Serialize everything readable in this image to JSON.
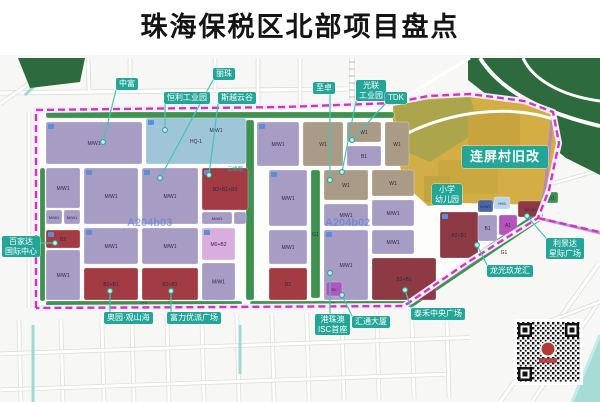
{
  "title": "珠海保税区北部项目盘点",
  "map": {
    "colors": {
      "purple": "#a79cc4",
      "lightblue": "#9fc6d8",
      "red": "#a23b42",
      "maroon": "#8e3a44",
      "tan": "#a99b85",
      "pink": "#d9aede",
      "magenta": "#b455bd",
      "steel": "#4a66aa",
      "pale": "#b9d6e8",
      "green": "#3f9150",
      "darkgreen": "#2d6b3f",
      "yellow": "#d2ae45",
      "olive": "#a8a44c",
      "boundary": "#cf35c4",
      "pointer": "#45c4b8",
      "water": "#a7dbd6",
      "areacode": "#5a7fd0",
      "chip": "#23a598"
    },
    "area_codes": [
      {
        "text": "A204b03",
        "x": 127,
        "y": 226
      },
      {
        "text": "A204b02",
        "x": 325,
        "y": 226
      }
    ],
    "road_labels": [
      {
        "text": "云峰路",
        "x": 235,
        "y": 171
      }
    ],
    "chips": [
      {
        "id": "zhongfu",
        "lines": [
          "中富"
        ],
        "x": 116,
        "y": 78,
        "dot": [
          103,
          142
        ]
      },
      {
        "id": "lizhu",
        "lines": [
          "丽珠"
        ],
        "x": 213,
        "y": 68,
        "dot": [
          160,
          178
        ]
      },
      {
        "id": "hengli",
        "lines": [
          "恒利工业园"
        ],
        "x": 164,
        "y": 92,
        "dot": [
          165,
          130
        ]
      },
      {
        "id": "siyue",
        "lines": [
          "斯越云谷"
        ],
        "x": 218,
        "y": 92,
        "dot": [
          209,
          175
        ]
      },
      {
        "id": "zhizhuo",
        "lines": [
          "至卓"
        ],
        "x": 313,
        "y": 82,
        "dot": [
          330,
          180
        ]
      },
      {
        "id": "guanglian",
        "lines": [
          "光联",
          "工业园"
        ],
        "x": 356,
        "y": 80,
        "dot": [
          342,
          172
        ]
      },
      {
        "id": "tdk",
        "lines": [
          "TDK"
        ],
        "x": 385,
        "y": 92,
        "dot": [
          352,
          140
        ]
      },
      {
        "id": "lianping",
        "lines": [
          "连屏村旧改"
        ],
        "x": 462,
        "y": 146,
        "big": true
      },
      {
        "id": "school",
        "lines": [
          "小学",
          "幼儿园"
        ],
        "x": 432,
        "y": 184
      },
      {
        "id": "baijiada",
        "lines": [
          "百家达",
          "国际中心"
        ],
        "x": 2,
        "y": 236,
        "dot": [
          55,
          243
        ]
      },
      {
        "id": "lijingda",
        "lines": [
          "利景达",
          "星际广场"
        ],
        "x": 546,
        "y": 238,
        "dot": [
          527,
          216
        ]
      },
      {
        "id": "longguang",
        "lines": [
          "龙光玖龙汇"
        ],
        "x": 487,
        "y": 265,
        "dot": [
          477,
          245
        ]
      },
      {
        "id": "taihe",
        "lines": [
          "泰禾中央广场"
        ],
        "x": 411,
        "y": 308,
        "dot": [
          405,
          290
        ]
      },
      {
        "id": "huitong",
        "lines": [
          "汇通大厦"
        ],
        "x": 352,
        "y": 316,
        "dot": [
          342,
          295
        ]
      },
      {
        "id": "isc",
        "lines": [
          "港珠澳",
          "ISC首座"
        ],
        "x": 315,
        "y": 314,
        "dot": [
          330,
          273
        ]
      },
      {
        "id": "aoyuan",
        "lines": [
          "奥园·观山海"
        ],
        "x": 104,
        "y": 312,
        "dot": [
          110,
          291
        ]
      },
      {
        "id": "fuli",
        "lines": [
          "富力优派广场"
        ],
        "x": 167,
        "y": 312,
        "dot": [
          171,
          291
        ]
      }
    ],
    "parcels": [
      {
        "x": 46,
        "y": 112,
        "w": 348,
        "h": 6,
        "c": "green",
        "t": ""
      },
      {
        "x": 40,
        "y": 168,
        "w": 5,
        "h": 133,
        "c": "green",
        "t": ""
      },
      {
        "x": 246,
        "y": 120,
        "w": 8,
        "h": 180,
        "c": "green",
        "t": ""
      },
      {
        "x": 46,
        "y": 301,
        "w": 196,
        "h": 6,
        "c": "green",
        "t": "G1"
      },
      {
        "x": 250,
        "y": 301,
        "w": 164,
        "h": 6,
        "c": "green",
        "t": "G1"
      },
      {
        "x": 311,
        "y": 170,
        "w": 9,
        "h": 128,
        "c": "green",
        "t": "G1"
      },
      {
        "x": 545,
        "y": 192,
        "w": 13,
        "h": 11,
        "c": "green",
        "t": "G1"
      },
      {
        "poly": "408,300 534,214 540,221 414,306",
        "c": "green"
      },
      {
        "x": 496,
        "y": 247,
        "w": 16,
        "h": 10,
        "c": "none",
        "t": "G1"
      },
      {
        "x": 46,
        "y": 122,
        "w": 96,
        "h": 42,
        "c": "purple",
        "t": "M/W1"
      },
      {
        "x": 146,
        "y": 118,
        "w": 100,
        "h": 46,
        "c": "lightblue",
        "t": "HQ-1"
      },
      {
        "x": 196,
        "y": 124,
        "w": 40,
        "h": 12,
        "c": "none",
        "t": "M/W1"
      },
      {
        "x": 46,
        "y": 168,
        "w": 34,
        "h": 40,
        "c": "purple",
        "t": "M/W1"
      },
      {
        "x": 46,
        "y": 210,
        "w": 16,
        "h": 14,
        "c": "purple",
        "t": "M/W1",
        "fs": 4
      },
      {
        "x": 64,
        "y": 210,
        "w": 16,
        "h": 14,
        "c": "purple",
        "t": "M/W1",
        "fs": 4
      },
      {
        "x": 84,
        "y": 168,
        "w": 54,
        "h": 56,
        "c": "purple",
        "t": "M/W1"
      },
      {
        "x": 142,
        "y": 168,
        "w": 56,
        "h": 56,
        "c": "purple",
        "t": "M/W1"
      },
      {
        "x": 202,
        "y": 168,
        "w": 46,
        "h": 42,
        "c": "red",
        "t": "B2+B1+B3"
      },
      {
        "x": 202,
        "y": 212,
        "w": 30,
        "h": 12,
        "c": "purple",
        "t": "M/W1",
        "fs": 4
      },
      {
        "x": 234,
        "y": 212,
        "w": 12,
        "h": 12,
        "c": "purple",
        "t": ""
      },
      {
        "x": 46,
        "y": 230,
        "w": 34,
        "h": 18,
        "c": "red",
        "t": "B2"
      },
      {
        "x": 46,
        "y": 250,
        "w": 34,
        "h": 50,
        "c": "purple",
        "t": "M/W1"
      },
      {
        "x": 84,
        "y": 228,
        "w": 54,
        "h": 36,
        "c": "purple",
        "t": "M/W1"
      },
      {
        "x": 84,
        "y": 268,
        "w": 54,
        "h": 32,
        "c": "red",
        "t": "B2+B1"
      },
      {
        "x": 142,
        "y": 228,
        "w": 56,
        "h": 36,
        "c": "purple",
        "t": "M/W1"
      },
      {
        "x": 142,
        "y": 268,
        "w": 56,
        "h": 32,
        "c": "red",
        "t": "B2+B1"
      },
      {
        "x": 202,
        "y": 228,
        "w": 33,
        "h": 32,
        "c": "pink",
        "t": "M0+B2"
      },
      {
        "x": 202,
        "y": 263,
        "w": 33,
        "h": 37,
        "c": "purple",
        "t": "M/W1"
      },
      {
        "x": 257,
        "y": 122,
        "w": 42,
        "h": 44,
        "c": "purple",
        "t": "M/W1"
      },
      {
        "x": 303,
        "y": 122,
        "w": 40,
        "h": 44,
        "c": "tan",
        "t": "W1"
      },
      {
        "x": 347,
        "y": 122,
        "w": 34,
        "h": 20,
        "c": "tan",
        "t": "W1"
      },
      {
        "x": 347,
        "y": 146,
        "w": 34,
        "h": 20,
        "c": "purple",
        "t": "B1"
      },
      {
        "x": 385,
        "y": 122,
        "w": 24,
        "h": 44,
        "c": "tan",
        "t": "W1"
      },
      {
        "x": 269,
        "y": 170,
        "w": 38,
        "h": 56,
        "c": "purple",
        "t": "M/W1"
      },
      {
        "x": 324,
        "y": 170,
        "w": 44,
        "h": 30,
        "c": "tan",
        "t": "W1"
      },
      {
        "x": 324,
        "y": 204,
        "w": 44,
        "h": 22,
        "c": "purple",
        "t": "M/W1"
      },
      {
        "x": 372,
        "y": 170,
        "w": 42,
        "h": 26,
        "c": "tan",
        "t": "W1"
      },
      {
        "x": 372,
        "y": 200,
        "w": 42,
        "h": 26,
        "c": "purple",
        "t": "M/W1"
      },
      {
        "x": 269,
        "y": 230,
        "w": 38,
        "h": 34,
        "c": "purple",
        "t": "M/W1"
      },
      {
        "x": 269,
        "y": 268,
        "w": 38,
        "h": 32,
        "c": "red",
        "t": "B2"
      },
      {
        "x": 324,
        "y": 230,
        "w": 44,
        "h": 70,
        "c": "purple",
        "t": "M/W1"
      },
      {
        "x": 326,
        "y": 282,
        "w": 16,
        "h": 14,
        "c": "magenta",
        "t": "B2",
        "fs": 4
      },
      {
        "x": 372,
        "y": 230,
        "w": 42,
        "h": 24,
        "c": "purple",
        "t": "M/W1"
      },
      {
        "x": 372,
        "y": 258,
        "w": 64,
        "h": 42,
        "c": "maroon",
        "t": "B2+B1"
      },
      {
        "x": 440,
        "y": 212,
        "w": 38,
        "h": 46,
        "c": "maroon",
        "t": "B2+B1"
      },
      {
        "x": 478,
        "y": 200,
        "w": 15,
        "h": 12,
        "c": "steel",
        "t": "M/W1",
        "fs": 4
      },
      {
        "x": 494,
        "y": 197,
        "w": 16,
        "h": 12,
        "c": "pale",
        "t": "H93",
        "fs": 4
      },
      {
        "x": 478,
        "y": 215,
        "w": 19,
        "h": 26,
        "c": "purple",
        "t": "B1"
      },
      {
        "x": 499,
        "y": 215,
        "w": 18,
        "h": 20,
        "c": "magenta",
        "t": "A1"
      },
      {
        "x": 518,
        "y": 201,
        "w": 25,
        "h": 16,
        "c": "maroon",
        "t": "B2+B3",
        "fs": 4
      }
    ]
  }
}
